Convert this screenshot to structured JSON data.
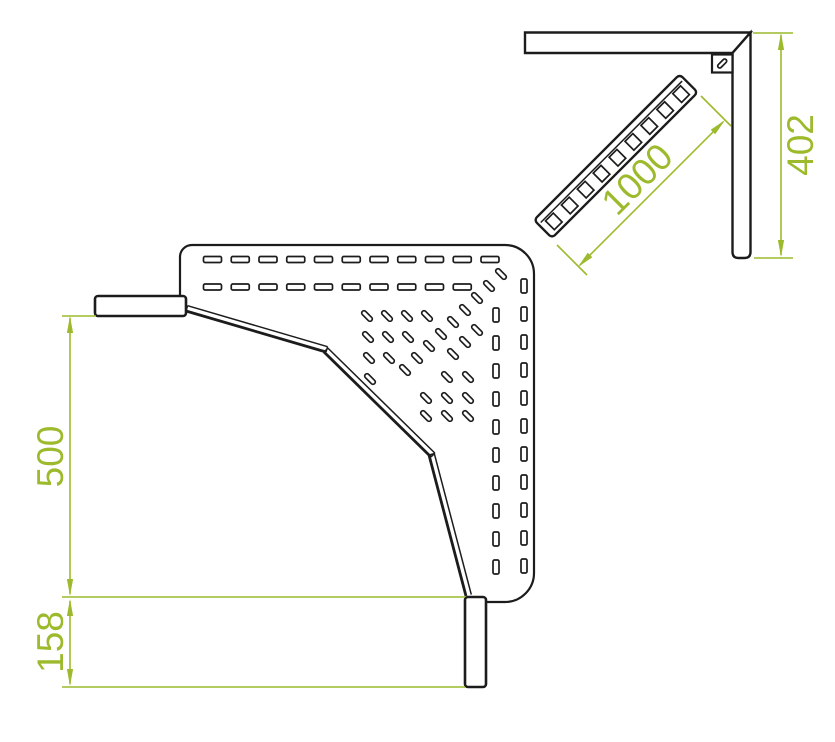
{
  "colors": {
    "background": "#ffffff",
    "line": "#1c1c1c",
    "dimension": "#9cba2c"
  },
  "plan_view": {
    "dim_tray_width_label": "500",
    "dim_end_rail_label": "158"
  },
  "elevation_view": {
    "dim_section_length_label": "1000",
    "dim_drop_height_label": "402"
  }
}
